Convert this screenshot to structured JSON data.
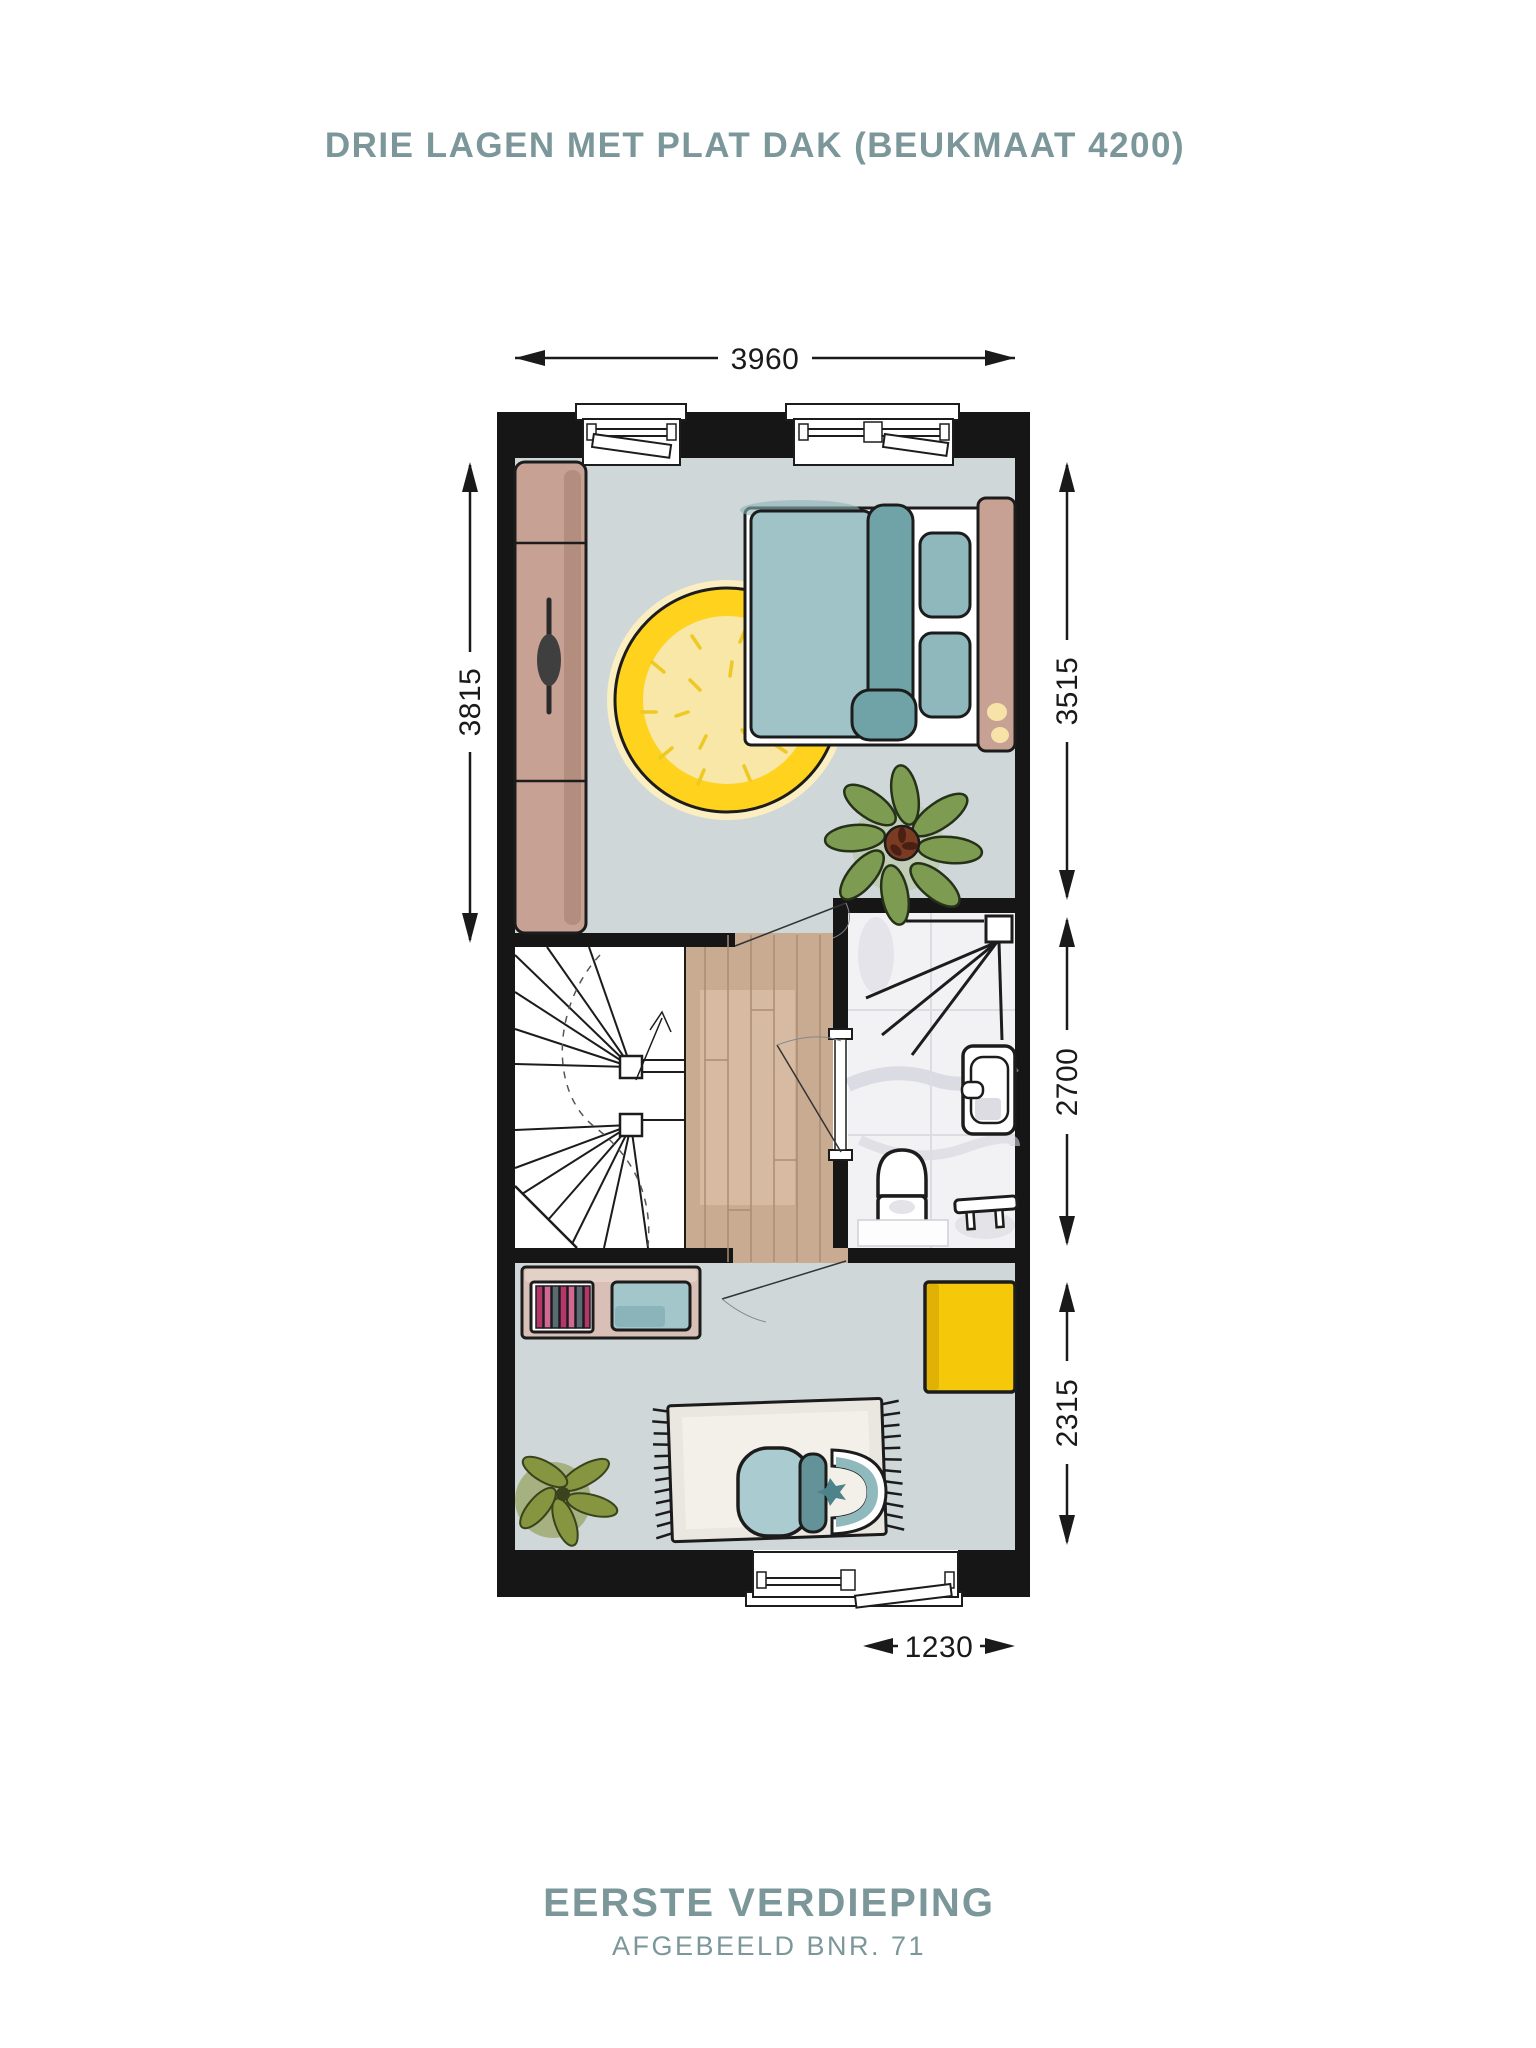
{
  "header": {
    "title": "DRIE LAGEN MET PLAT DAK (BEUKMAAT 4200)"
  },
  "footer": {
    "floor_name": "EERSTE VERDIEPING",
    "plot_label": "AFGEBEELD BNR. 71"
  },
  "dimensions_mm": {
    "top_width": "3960",
    "left_bedroom_depth": "3815",
    "right_bedroom_depth": "3515",
    "right_middle_depth": "2700",
    "right_bottom_depth": "2315",
    "bottom_window_width": "1230"
  },
  "colors": {
    "accent_text": "#7c9799",
    "wall": "#161616",
    "floor": "#cfd7d8",
    "wood": "#c9ab92",
    "marble": "#f2f2f5",
    "furniture_tan": "#c7a294",
    "bed_teal_light": "#9fc3c6",
    "bed_teal_dark": "#6fa3a8",
    "rug_yellow": "#ffd21e",
    "cabinet_yellow": "#f6c80a",
    "plant_green": "#7d9c52",
    "rug_cream": "#eae6e0"
  }
}
